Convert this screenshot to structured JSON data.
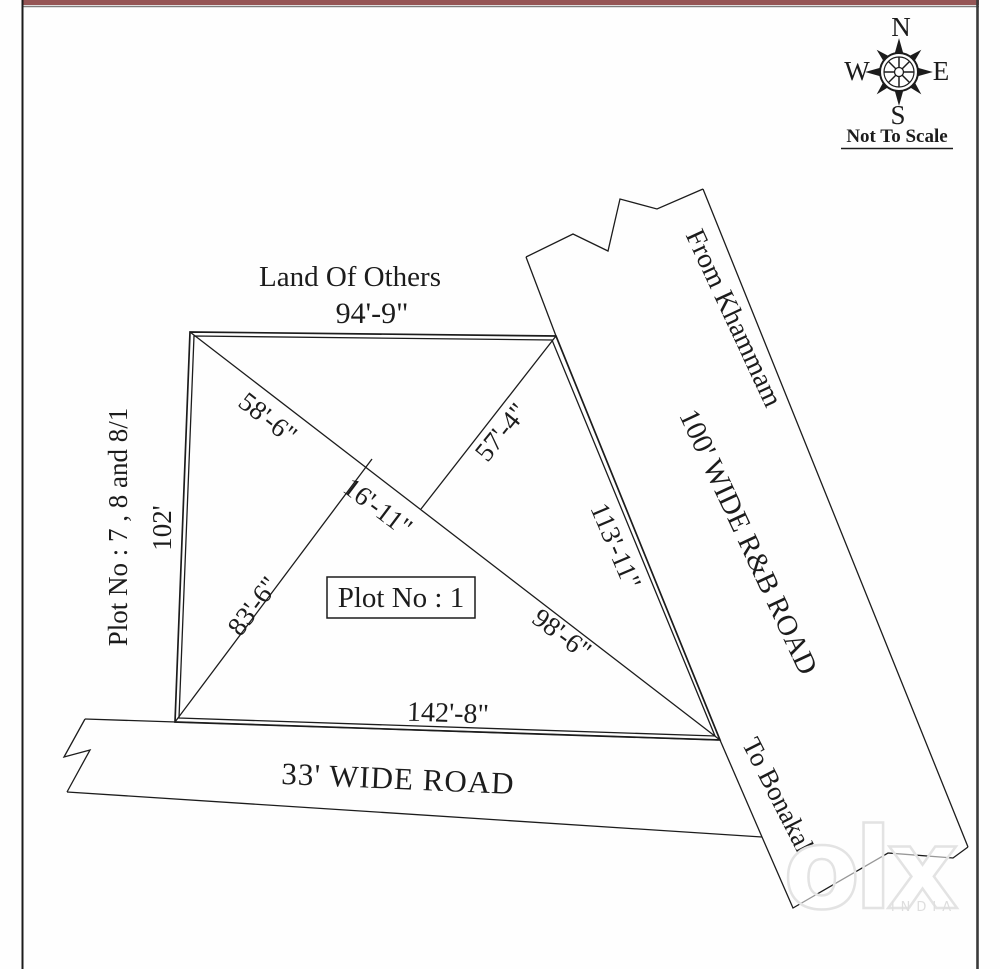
{
  "labels": {
    "land_of_others": "Land Of Others",
    "plot_box": "Plot No : 1",
    "left_owner": "Plot No : 7 , 8 and 8/1"
  },
  "measurements": {
    "top_edge": "94'-9\"",
    "left_edge": "102'",
    "bottom_edge": "142'-8\"",
    "right_edge": "113'-11\"",
    "diagonal_upper": "58'-6\"",
    "diagonal_middle": "16'-11\"",
    "diagonal_lower": "98'-6\"",
    "diagonal_from_bl": "83'-6\"",
    "diagonal_from_tr": "57'-4\""
  },
  "roads": {
    "bottom_road": "33' WIDE ROAD",
    "right_road": "100' WIDE R&B ROAD",
    "from_label": "From Khammam",
    "to_label": "To Bonakal"
  },
  "compass": {
    "north": "N",
    "south": "S",
    "east": "E",
    "west": "W",
    "note": "Not To Scale"
  },
  "watermark": {
    "logo": "olx",
    "sub": "INDIA"
  },
  "colors": {
    "ink": "#1c1c1c",
    "boundary_red": "#b06060",
    "frame_maroon": "#955555"
  }
}
